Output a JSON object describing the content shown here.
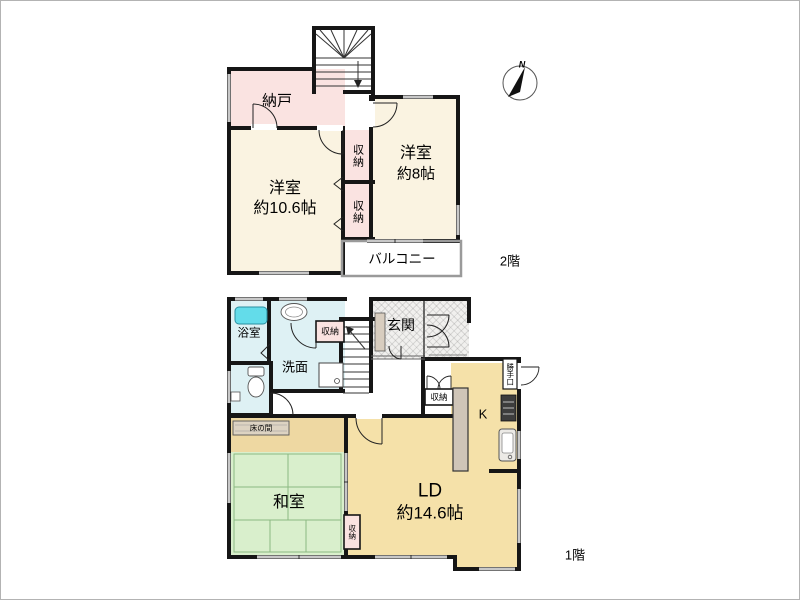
{
  "compass": {
    "north": "N"
  },
  "floor2": {
    "label": "2階",
    "rooms": {
      "nando": "納戸",
      "western_large": {
        "name": "洋室",
        "size": "約10.6帖"
      },
      "western_small": {
        "name": "洋室",
        "size": "約8帖"
      },
      "closet_upper": "収納",
      "closet_lower": "収納",
      "balcony": "バルコニー"
    }
  },
  "floor1": {
    "label": "1階",
    "rooms": {
      "bathroom": "浴室",
      "washroom": "洗面",
      "hall_closet": "収納",
      "entrance": "玄関",
      "kitchen": "K",
      "back_door": "勝手口",
      "ld_closet": "収納",
      "living_dining": {
        "name": "LD",
        "size": "約14.6帖"
      },
      "tokonoma": "床の間",
      "japanese_room": "和室",
      "washitsu_closet": "収納"
    }
  },
  "colors": {
    "wall": "#161616",
    "western_room": "#faf3e1",
    "ld_kitchen": "#f5e1a9",
    "tokonoma_zone": "#eed8a2",
    "closet_pink": "#fae3e1",
    "tatami_green": "#d9efcc",
    "wet_area_blue": "#def1f4",
    "bathtub_cyan": "#63dcea",
    "counter_gray": "#cfc5b8"
  }
}
